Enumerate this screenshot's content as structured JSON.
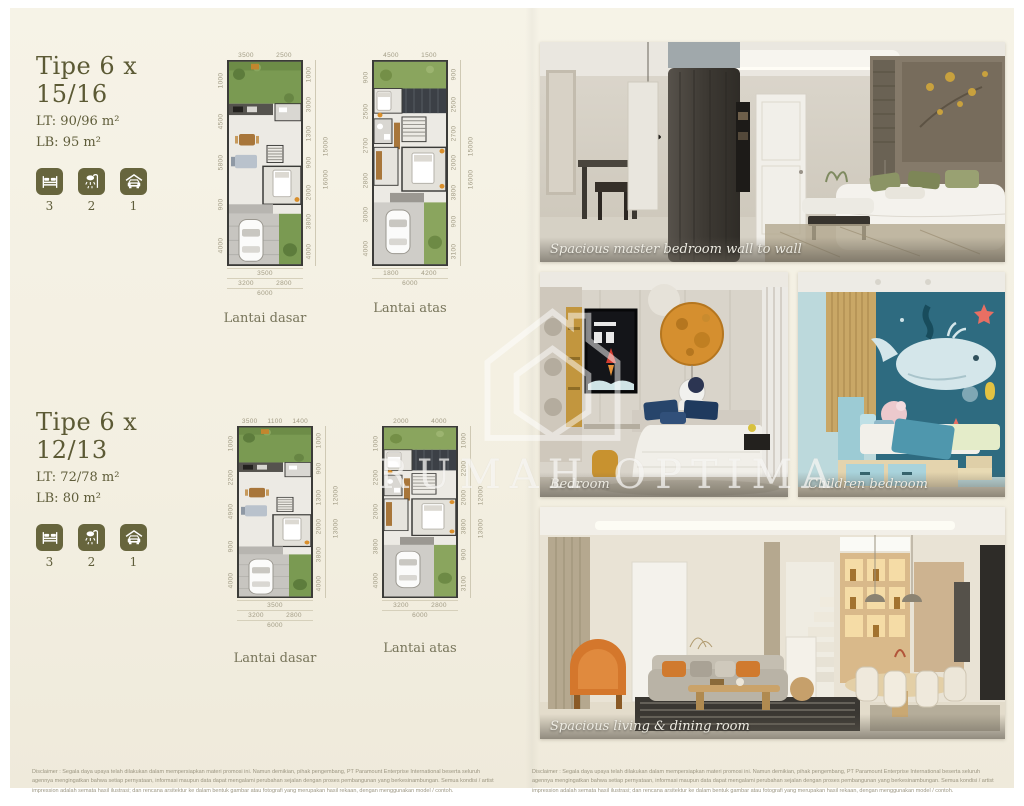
{
  "colors": {
    "accent_olive": "#67653d",
    "cream_bg": "#f4f1e4",
    "plan_green": "#7a9a52",
    "children_teal": "#2e6b80",
    "armchair_orange": "#d4772c"
  },
  "watermark": {
    "text": "RUMAH OPTIMA",
    "logo": "house-outline-logo"
  },
  "types": [
    {
      "name": "Tipe 6 x 15/16",
      "lt": "LT: 90/96 m²",
      "lb": "LB: 95 m²",
      "stats": [
        {
          "icon": "bed-icon",
          "count": "3"
        },
        {
          "icon": "shower-icon",
          "count": "2"
        },
        {
          "icon": "car-icon",
          "count": "1"
        }
      ],
      "plans": [
        {
          "caption": "Lantai dasar",
          "dims": {
            "top": [
              "3500",
              "2500"
            ],
            "left": [
              "1000",
              "4500",
              "5800",
              "900",
              "4000"
            ],
            "right": [
              "1000",
              "3000",
              "1300",
              "900",
              "2000",
              "3800",
              "4000"
            ],
            "totals": [
              "15000",
              "16000"
            ],
            "bottom": [
              [
                "3500"
              ],
              [
                "3200",
                "2800"
              ],
              [
                "6000"
              ]
            ]
          }
        },
        {
          "caption": "Lantai atas",
          "dims": {
            "top": [
              "4500",
              "1500"
            ],
            "left": [
              "900",
              "2500",
              "2700",
              "2800",
              "3000",
              "4000"
            ],
            "right": [
              "900",
              "2500",
              "2700",
              "2000",
              "3800",
              "900",
              "3100"
            ],
            "totals": [
              "15000",
              "16000"
            ],
            "bottom": [
              [
                "1800",
                "4200"
              ],
              [
                "6000"
              ]
            ]
          }
        }
      ]
    },
    {
      "name": "Tipe 6 x 12/13",
      "lt": "LT: 72/78 m²",
      "lb": "LB: 80 m²",
      "stats": [
        {
          "icon": "bed-icon",
          "count": "3"
        },
        {
          "icon": "shower-icon",
          "count": "2"
        },
        {
          "icon": "car-icon",
          "count": "1"
        }
      ],
      "plans": [
        {
          "caption": "Lantai dasar",
          "dims": {
            "top": [
              "3500",
              "1100",
              "1400"
            ],
            "left": [
              "1000",
              "2200",
              "4900",
              "900",
              "4000"
            ],
            "right": [
              "1000",
              "900",
              "1300",
              "2000",
              "3800",
              "4000"
            ],
            "totals": [
              "12000",
              "13000"
            ],
            "bottom": [
              [
                "3500"
              ],
              [
                "3200",
                "2800"
              ],
              [
                "6000"
              ]
            ]
          }
        },
        {
          "caption": "Lantai atas",
          "dims": {
            "top": [
              "2000",
              "4000"
            ],
            "left": [
              "1000",
              "2200",
              "2000",
              "3800",
              "4000"
            ],
            "right": [
              "1000",
              "2200",
              "2000",
              "3800",
              "900",
              "3100"
            ],
            "totals": [
              "12000",
              "13000"
            ],
            "bottom": [
              [
                "3200",
                "2800"
              ],
              [
                "6000"
              ]
            ]
          }
        }
      ]
    }
  ],
  "photos": [
    {
      "caption": "Spacious master bedroom wall to wall",
      "scene": "master-bedroom"
    },
    {
      "caption": "Bedroom",
      "scene": "bedroom"
    },
    {
      "caption": "Children bedroom",
      "scene": "children-bedroom"
    },
    {
      "caption": "Spacious living & dining room",
      "scene": "living-dining"
    }
  ],
  "disclaimer": {
    "text": "Disclaimer : Segala daya upaya telah dilakukan dalam mempersiapkan materi promosi ini. Namun demikian, pihak pengembang, PT Paramount Enterprise International beserta seluruh agennya mengingatkan bahwa setiap pernyataan, informasi maupun data dapat mengalami perubahan sejalan dengan proses pembangunan yang berkesinambungan. Semua kondisi / artist impression adalah semata hasil ilustrasi; dan rencana arsitektur ke dalam bentuk gambar atau fotografi yang merupakan hasil rekaan, dengan menggunakan model / contoh."
  }
}
